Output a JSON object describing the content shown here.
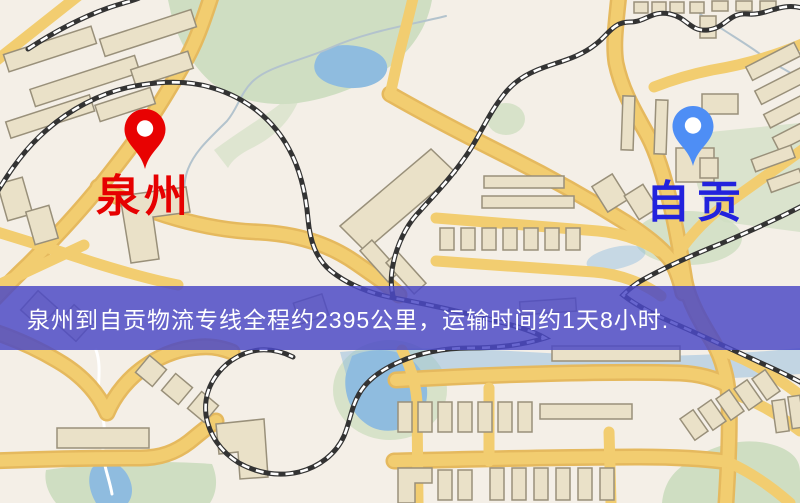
{
  "markers": {
    "origin": {
      "label": "泉州"
    },
    "destination": {
      "label": "自贡"
    }
  },
  "banner": {
    "text": "泉州到自贡物流专线全程约2395公里，运输时间约1天8小时."
  },
  "colors": {
    "origin_label": "#e60000",
    "destination_label": "#2222dd",
    "origin_pin": "#e80202",
    "destination_pin": "#4e8ef5",
    "banner_bg": "#4b49c6",
    "banner_text": "#ffffff",
    "map_background": "#f4efe7",
    "road_yellow": "#f2cd70",
    "road_casing": "#e5b95e",
    "park_green": "#cfdec2",
    "water_blue": "#8fbcdf",
    "building_fill": "#eae1c8",
    "building_stroke": "#99907a",
    "railway_dark": "#333333"
  }
}
